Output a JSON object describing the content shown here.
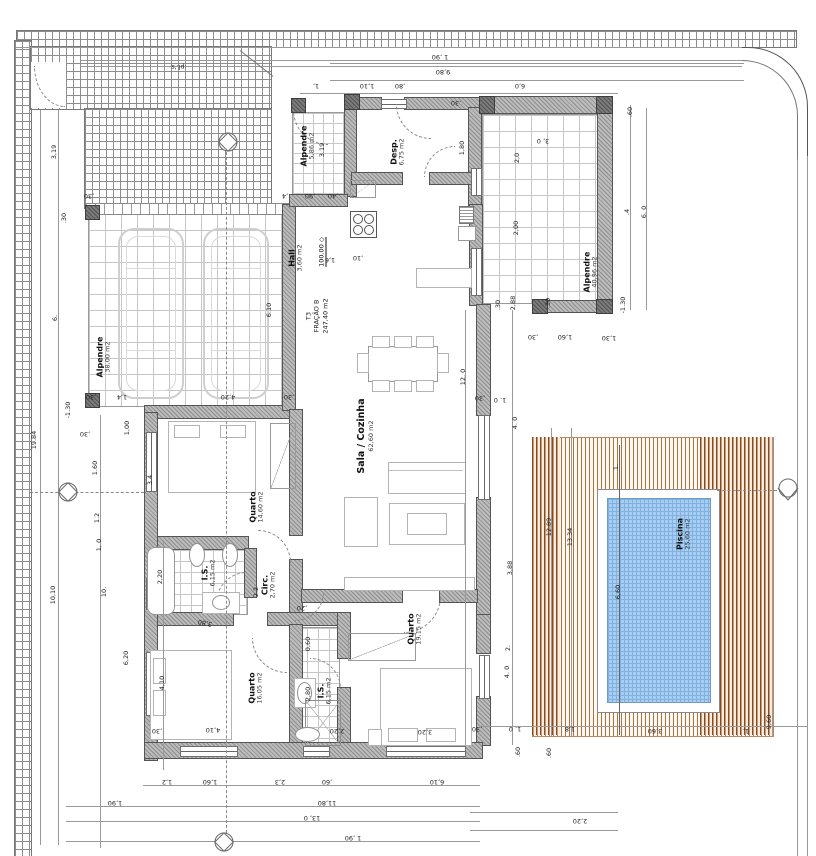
{
  "title_block": {
    "unit": "T3",
    "fraction": "FRAÇÃO B",
    "total_area": "247,40 m2"
  },
  "rooms": [
    {
      "id": "alpendre-garage",
      "name": "Alpendre",
      "area": "38,00 m2"
    },
    {
      "id": "alpendre-top",
      "name": "Alpendre",
      "area": "5,86 m2"
    },
    {
      "id": "desp",
      "name": "Desp.",
      "area": "6,75 m2"
    },
    {
      "id": "hall",
      "name": "Hall",
      "area": "3,60 m2"
    },
    {
      "id": "alpendre-right",
      "name": "Alpendre",
      "area": "40,96 m2"
    },
    {
      "id": "sala-cozinha",
      "name": "Sala / Cozinha",
      "area": "62,60 m2"
    },
    {
      "id": "quarto-1",
      "name": "Quarto",
      "area": "14,60 m2"
    },
    {
      "id": "is-1",
      "name": "I.S.",
      "area": "6,15 m2"
    },
    {
      "id": "circ",
      "name": "Circ.",
      "area": "2,70 m2"
    },
    {
      "id": "quarto-2",
      "name": "Quarto",
      "area": "16,05 m2"
    },
    {
      "id": "is-2",
      "name": "I.S.",
      "area": "6,15 m2"
    },
    {
      "id": "quarto-3",
      "name": "Quarto",
      "area": "19,15 m2"
    },
    {
      "id": "piscina",
      "name": "Piscina",
      "area": "25,60 m2"
    }
  ],
  "level_marks": [
    {
      "value": "100.00"
    }
  ],
  "dimensions": [
    [
      "1 ,90",
      440,
      57,
      180
    ],
    [
      "9,80",
      443,
      72,
      180
    ],
    [
      "1,",
      316,
      86,
      180
    ],
    [
      "1,10",
      367,
      86,
      180
    ],
    [
      ",80",
      400,
      86,
      180
    ],
    [
      "6,0",
      520,
      86,
      180
    ],
    [
      "pl.'s",
      178,
      67,
      180
    ],
    [
      ".60",
      630,
      112,
      -90
    ],
    [
      "3, 0",
      543,
      141,
      180
    ],
    [
      "6. 0",
      644,
      212,
      -90
    ],
    [
      ".4",
      627,
      212,
      -90
    ],
    [
      "2,0",
      517,
      158,
      -90
    ],
    [
      "2,00",
      516,
      228,
      -90
    ],
    [
      "2,88",
      513,
      303,
      -90
    ],
    [
      "-1.30",
      623,
      305,
      -90
    ],
    [
      "1,80",
      462,
      148,
      -90
    ],
    [
      ".30",
      456,
      103,
      180
    ],
    [
      "3.19",
      322,
      150,
      -90
    ],
    [
      ",4",
      285,
      196,
      180
    ],
    [
      ",90",
      310,
      196,
      180
    ],
    [
      ",40",
      333,
      196,
      180
    ],
    [
      "1,6",
      330,
      260,
      180
    ],
    [
      ",10",
      358,
      258,
      180
    ],
    [
      "3,19",
      54,
      152,
      -90
    ],
    [
      ".30",
      64,
      218,
      -90
    ],
    [
      "19.84",
      34,
      440,
      -90
    ],
    [
      "6.",
      55,
      318,
      -90
    ],
    [
      "6.10",
      269,
      310,
      -90
    ],
    [
      ",30",
      91,
      397,
      180
    ],
    [
      "1,4",
      122,
      397,
      180
    ],
    [
      "4,20",
      228,
      397,
      180
    ],
    [
      ",30",
      289,
      397,
      180
    ],
    [
      ",30",
      89,
      196,
      180
    ],
    [
      "-1.30",
      68,
      410,
      -90
    ],
    [
      ",30",
      85,
      434,
      180
    ],
    [
      "1,00",
      127,
      428,
      -90
    ],
    [
      "1.60",
      95,
      468,
      -90
    ],
    [
      "3.4",
      150,
      480,
      -90
    ],
    [
      "1.2",
      97,
      518,
      -90
    ],
    [
      "1, 0",
      99,
      545,
      -90
    ],
    [
      "10,10",
      53,
      595,
      -90
    ],
    [
      "10.",
      104,
      592,
      -90
    ],
    [
      "6,20",
      126,
      658,
      -90
    ],
    [
      "2,20",
      160,
      577,
      -90
    ],
    [
      "4,10",
      162,
      683,
      -90
    ],
    [
      "2.2",
      256,
      592,
      -90
    ],
    [
      "3,80",
      205,
      623,
      192
    ],
    [
      "2,80",
      308,
      694,
      -90
    ],
    [
      "0,60",
      308,
      644,
      -90
    ],
    [
      ",20",
      302,
      608,
      180
    ],
    [
      "12. 0",
      463,
      377,
      -90
    ],
    [
      ",30",
      480,
      398,
      180
    ],
    [
      "1. 0",
      500,
      400,
      180
    ],
    [
      ",30",
      533,
      337,
      180
    ],
    [
      "1,60",
      565,
      337,
      180
    ],
    [
      "1,30",
      609,
      338,
      180
    ],
    [
      "4. 0",
      515,
      423,
      -90
    ],
    [
      ".30",
      498,
      305,
      -90
    ],
    [
      ".30",
      548,
      303,
      -90
    ],
    [
      "3,88",
      510,
      568,
      -90
    ],
    [
      "2.",
      508,
      648,
      -90
    ],
    [
      "4. 0",
      507,
      672,
      -90
    ],
    [
      "12.89",
      549,
      527,
      -90
    ],
    [
      "13.34",
      570,
      537,
      -90
    ],
    [
      "1.",
      616,
      467,
      -90
    ],
    [
      "6,60",
      618,
      592,
      -90
    ],
    [
      "1,2",
      167,
      782,
      180
    ],
    [
      "1,60",
      210,
      782,
      180
    ],
    [
      "2,3",
      280,
      782,
      180
    ],
    [
      ",60",
      327,
      782,
      180
    ],
    [
      "6,10",
      437,
      782,
      180
    ],
    [
      "1,90",
      115,
      803,
      180
    ],
    [
      "11,80",
      327,
      803,
      180
    ],
    [
      "13, 0",
      312,
      818,
      180
    ],
    [
      "1 ,90",
      353,
      838,
      180
    ],
    [
      "4,10",
      213,
      730,
      180
    ],
    [
      "2,20",
      337,
      731,
      180
    ],
    [
      "3,20",
      425,
      732,
      180
    ],
    [
      ",30",
      157,
      731,
      180
    ],
    [
      "1. 0",
      515,
      729,
      180
    ],
    [
      ",30",
      477,
      729,
      180
    ],
    [
      "1,8",
      570,
      729,
      180
    ],
    [
      "3,60",
      655,
      731,
      180
    ],
    [
      "1,",
      746,
      731,
      180
    ],
    [
      "2,20",
      580,
      821,
      180
    ],
    [
      ".60",
      518,
      752,
      -90
    ],
    [
      ".60",
      549,
      753,
      -90
    ],
    [
      "9,60",
      769,
      722,
      -90
    ]
  ],
  "markers": [
    {
      "x": 228,
      "y": 142
    },
    {
      "x": 68,
      "y": 492
    },
    {
      "x": 788,
      "y": 490
    },
    {
      "x": 224,
      "y": 843
    }
  ],
  "colors": {
    "deck_stripe": "#b5713a",
    "deck_dark": "#8a4a1f",
    "pool_fill": "#a9cdf1",
    "pool_grid": "#7fb2e0",
    "wall_fill": "#bcbcbc",
    "wall_hatch": "#8f8f8f"
  }
}
